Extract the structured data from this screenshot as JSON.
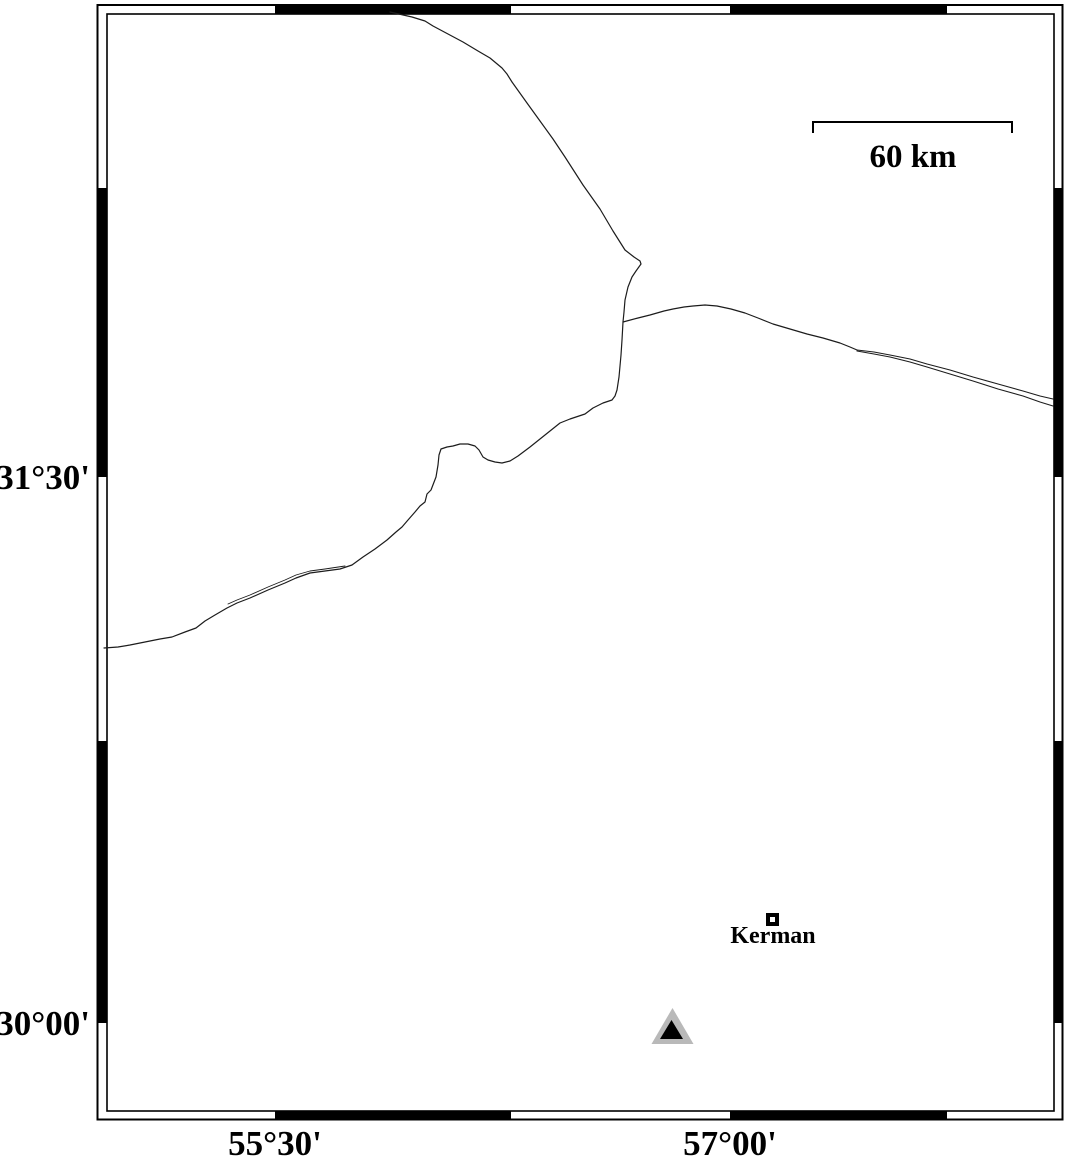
{
  "map_type": "geographic-basemap",
  "colors": {
    "background": "#ffffff",
    "frame": "#000000",
    "line": "#1c1c1c",
    "station_fill": "#b9b9b9",
    "station_core": "#000000",
    "text": "#000000"
  },
  "axes": {
    "lat": [
      {
        "label": "31°30'"
      },
      {
        "label": "30°00'"
      }
    ],
    "lon": [
      {
        "label": "55°30'"
      },
      {
        "label": "57°00'"
      }
    ]
  },
  "scale_bar": {
    "label": "60 km"
  },
  "markers": {
    "city": {
      "name": "Kerman",
      "symbol": "square-icon"
    },
    "station": {
      "symbol": "triangle-icon"
    }
  }
}
